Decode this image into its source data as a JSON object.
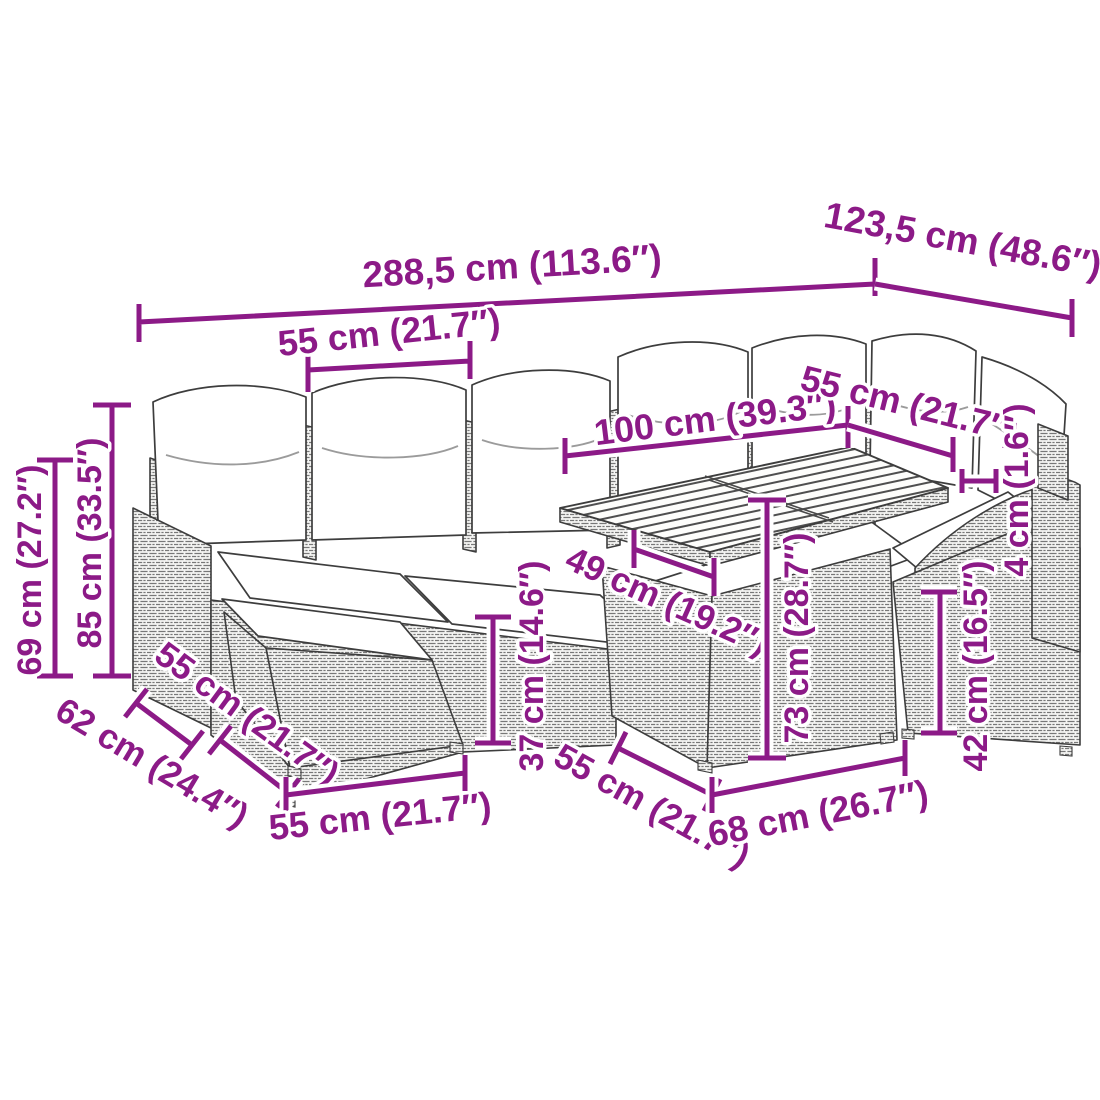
{
  "colors": {
    "dimension": "#8C1A87",
    "outline": "#3D3D3D",
    "cushion": "#FFFFFF",
    "background": "#FFFFFF"
  },
  "dims": [
    {
      "name": "total-width",
      "text": "288,5 cm (113.6″)"
    },
    {
      "name": "total-depth",
      "text": "123,5 cm (48.6″)"
    },
    {
      "name": "left-seat-width",
      "text": "55 cm (21.7″)"
    },
    {
      "name": "back-section-width",
      "text": "100 cm (39.3″)"
    },
    {
      "name": "right-seat-width",
      "text": "55 cm (21.7″)"
    },
    {
      "name": "tabletop-thickness",
      "text": "4 cm (1.6″)"
    },
    {
      "name": "total-height",
      "text": "85 cm (33.5″)"
    },
    {
      "name": "arm-height",
      "text": "69 cm (27.2″)"
    },
    {
      "name": "side-depth",
      "text": "62 cm (24.4″)"
    },
    {
      "name": "ottoman-depth",
      "text": "55 cm (21.7″)"
    },
    {
      "name": "ottoman-width",
      "text": "55 cm (21.7″)"
    },
    {
      "name": "seat-height",
      "text": "37 cm (14.6″)"
    },
    {
      "name": "table-clearance",
      "text": "49 cm (19.2″)"
    },
    {
      "name": "table-height",
      "text": "73 cm (28.7″)"
    },
    {
      "name": "table-depth",
      "text": "55 cm (21.7″)"
    },
    {
      "name": "table-width",
      "text": "68 cm (26.7″)"
    },
    {
      "name": "right-seat-height",
      "text": "42 cm (16.5″)"
    }
  ]
}
